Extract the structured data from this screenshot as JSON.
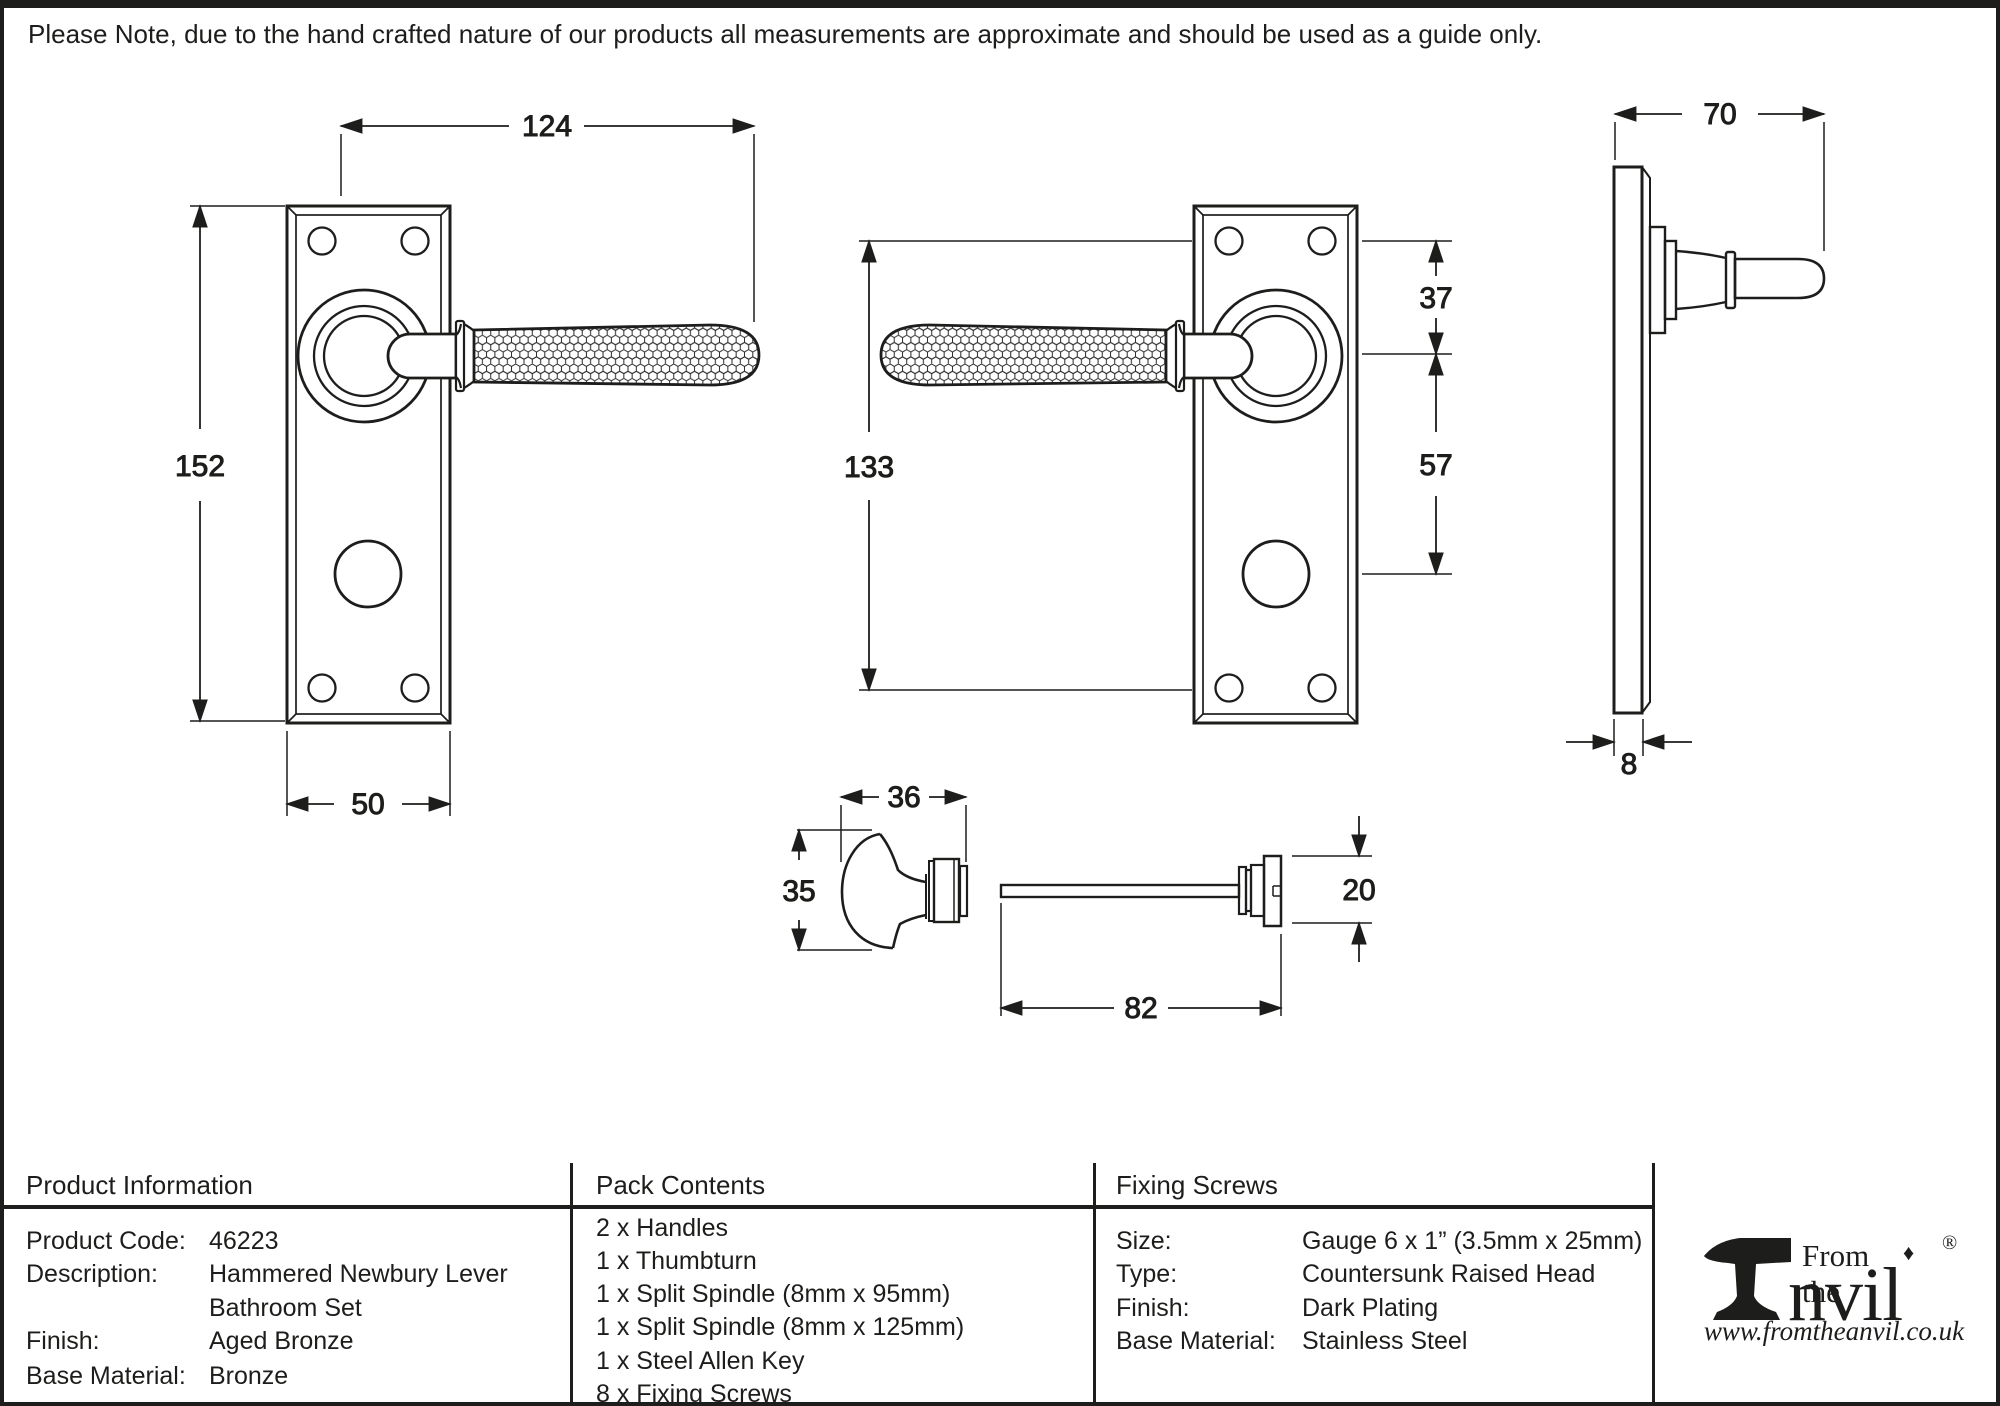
{
  "colors": {
    "ink": "#1d1d1b",
    "paper": "#ffffff"
  },
  "drawings": {
    "front_view": {
      "dim_width": "124",
      "dim_height": "152",
      "dim_plate_width": "50"
    },
    "reverse_view": {
      "dim_height": "133",
      "dim_top_offset": "37",
      "dim_centres": "57"
    },
    "side_view": {
      "dim_projection": "70",
      "dim_plate_thickness": "8"
    },
    "thumbturn": {
      "dim_knob_width": "36",
      "dim_knob_height": "35",
      "dim_spindle_length": "82",
      "dim_release_height": "20"
    }
  },
  "note": {
    "text": "Please Note, due to the hand crafted nature of our products all measurements are approximate and should be used as a guide only."
  },
  "product_info": {
    "header": "Product Information",
    "rows": [
      {
        "label": "Product Code:",
        "value": "46223"
      },
      {
        "label": "Description:",
        "value": "Hammered Newbury Lever",
        "value2": "Bathroom Set"
      },
      {
        "label": "Finish:",
        "value": "Aged Bronze"
      },
      {
        "label": "Base Material:",
        "value": "Bronze"
      }
    ]
  },
  "pack_contents": {
    "header": "Pack Contents",
    "items": [
      "2 x Handles",
      "1 x Thumbturn",
      "1 x Split Spindle (8mm x 95mm)",
      "1 x Split Spindle (8mm x 125mm)",
      "1 x Steel Allen Key",
      "8 x Fixing Screws"
    ]
  },
  "fixing_screws": {
    "header": "Fixing Screws",
    "rows": [
      {
        "label": "Size:",
        "value": "Gauge 6 x 1” (3.5mm x 25mm)"
      },
      {
        "label": "Type:",
        "value": "Countersunk Raised Head"
      },
      {
        "label": "Finish:",
        "value": "Dark Plating"
      },
      {
        "label": "Base Material:",
        "value": "Stainless Steel"
      }
    ]
  },
  "brand": {
    "prefix": "From the",
    "diamond": "♦",
    "name_rest": "nvil",
    "reg": "®",
    "website": "www.fromtheanvil.co.uk"
  }
}
